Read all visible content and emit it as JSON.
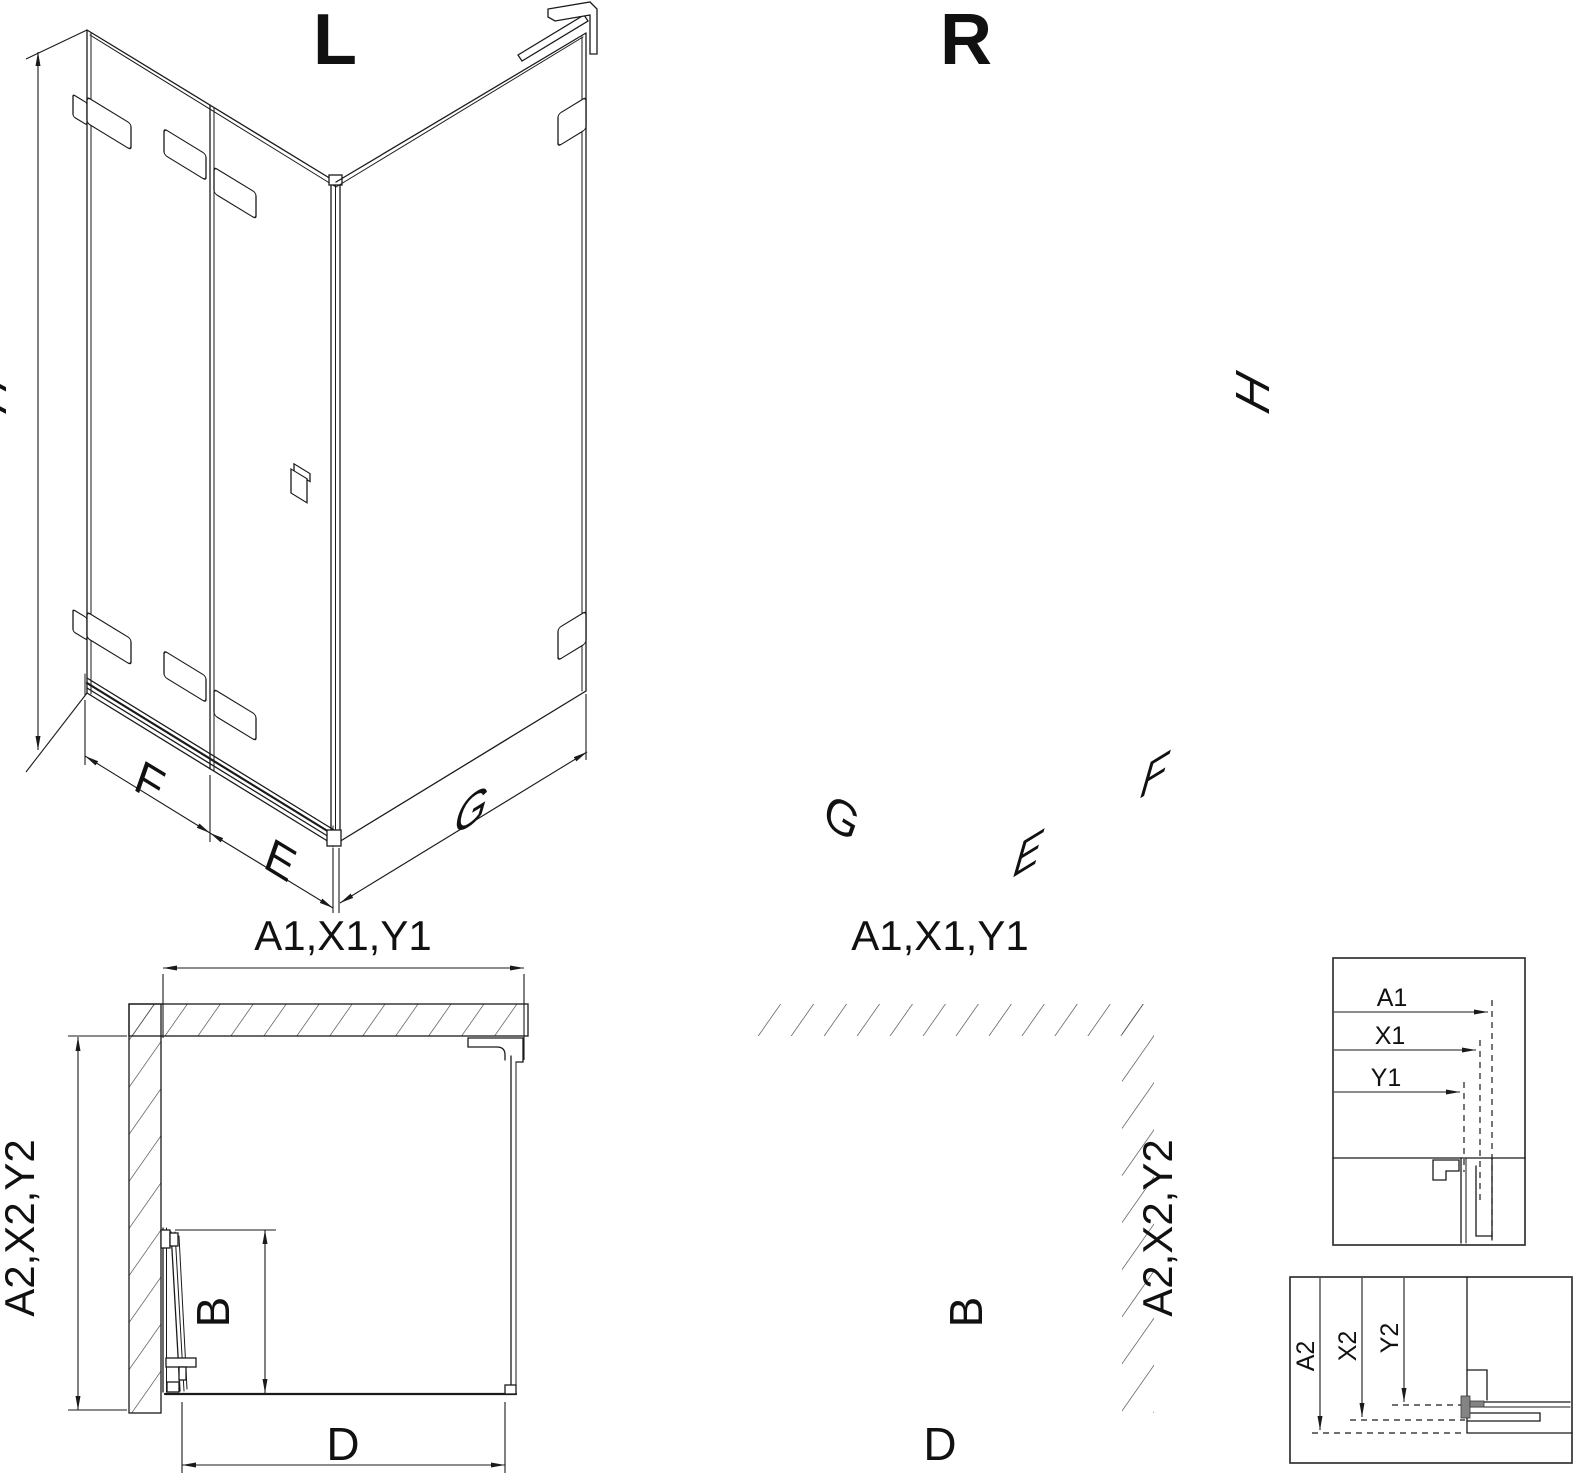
{
  "colors": {
    "line": "#1a1a1a",
    "hatch": "#3c3c3c",
    "detail_border": "#333333",
    "background": "#ffffff"
  },
  "views": {
    "iso_left": {
      "label": "L",
      "dim_height": "H",
      "dim_fixed_panel": "F",
      "dim_door_panel": "E",
      "dim_side_panel": "G"
    },
    "iso_right": {
      "label": "R",
      "dim_height": "H",
      "dim_fixed_panel": "F",
      "dim_door_panel": "E",
      "dim_side_panel": "G"
    },
    "plan_left": {
      "dim_width": "A1,X1,Y1",
      "dim_depth": "A2,X2,Y2",
      "dim_door_swing": "B",
      "dim_opening": "D"
    },
    "plan_right": {
      "dim_width": "A1,X1,Y1",
      "dim_depth": "A2,X2,Y2",
      "dim_door_swing": "B",
      "dim_opening": "D"
    },
    "detail_width_section": {
      "dims": [
        "A1",
        "X1",
        "Y1"
      ]
    },
    "detail_depth_section": {
      "dims": [
        "A2",
        "X2",
        "Y2"
      ]
    }
  }
}
